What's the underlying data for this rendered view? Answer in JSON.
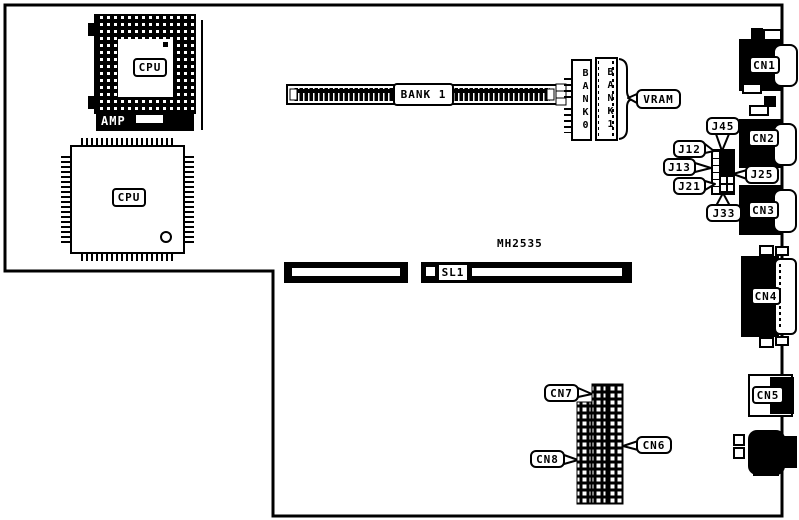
{
  "board": {
    "model_text": "MH2535"
  },
  "chips": {
    "socket_cpu_label": "CPU",
    "qfp_cpu_label": "CPU",
    "amp_label": "AMP"
  },
  "memory": {
    "bank1_h": "BANK 1",
    "bank0_v": "BANK0",
    "bank1_v": "BANK1",
    "vram": "VRAM"
  },
  "jumpers": {
    "j45": "J45",
    "j12": "J12",
    "j13": "J13",
    "j21": "J21",
    "j33": "J33",
    "j25": "J25"
  },
  "slots": {
    "sl1": "SL1"
  },
  "connectors": {
    "cn1": "CN1",
    "cn2": "CN2",
    "cn3": "CN3",
    "cn4": "CN4",
    "cn5": "CN5",
    "cn6": "CN6",
    "cn7": "CN7",
    "cn8": "CN8"
  },
  "colors": {
    "line": "#000000",
    "background": "#ffffff"
  }
}
